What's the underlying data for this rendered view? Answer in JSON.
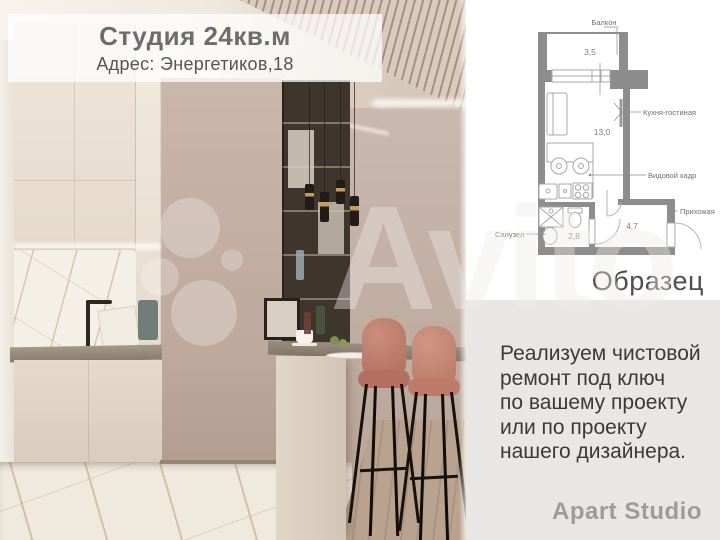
{
  "overlay": {
    "title": "Студия 24кв.м",
    "address": "Адрес: Энергетиков,18"
  },
  "floor_plan": {
    "labels": {
      "balcony": "Балкон",
      "balcony_area": "3,5",
      "kitchen_living": "Кухня-гостиная",
      "kitchen_living_area": "13,0",
      "view_frame": "Видовой кадр",
      "bathroom": "Санузел",
      "bathroom_area": "2,8",
      "hallway": "Прихожая",
      "hallway_area": "4,7"
    },
    "sample_label": "Образец"
  },
  "promo": {
    "lines": [
      "Реализуем чистовой",
      "ремонт под ключ",
      "по вашему проекту",
      "или по проекту",
      "нашего дизайнера."
    ],
    "brand": "Apart Studio"
  },
  "watermark": {
    "text": "Avito"
  },
  "colors": {
    "stool_pink": "#bd7d6e",
    "wall_taupe": "#c3b0a7",
    "plan_wall_gray": "#8d8d8d",
    "panel_gray": "#e8e7e5",
    "promo_text": "#3a3a3a",
    "brand_gray": "#9c9c9c"
  }
}
